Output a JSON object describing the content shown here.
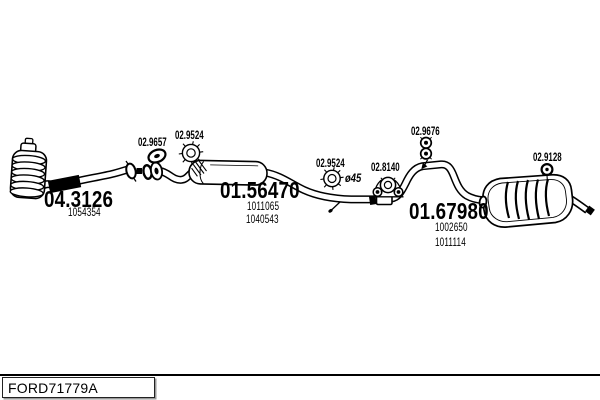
{
  "colors": {
    "ink": "#000000",
    "paper": "#ffffff"
  },
  "footer": {
    "code": "FORD71779A"
  },
  "parts": {
    "front_pipe": {
      "ref": "04.3126",
      "numbers": [
        "1054354"
      ]
    },
    "center_muffler": {
      "ref": "01.56470",
      "numbers": [
        "1011065",
        "1040543"
      ]
    },
    "rear_muffler": {
      "ref": "01.67980",
      "numbers": [
        "1002650",
        "1011114"
      ]
    }
  },
  "fittings": {
    "gasket": {
      "ref": "02.9657"
    },
    "front_clamp": {
      "ref": "02.9524"
    },
    "mid_clamp": {
      "ref": "02.9524",
      "diameter_note": "ø45"
    },
    "rubber_mount": {
      "ref": "02.8140"
    },
    "hanger": {
      "ref": "02.9676"
    },
    "tail_washer": {
      "ref": "02.9128"
    }
  }
}
